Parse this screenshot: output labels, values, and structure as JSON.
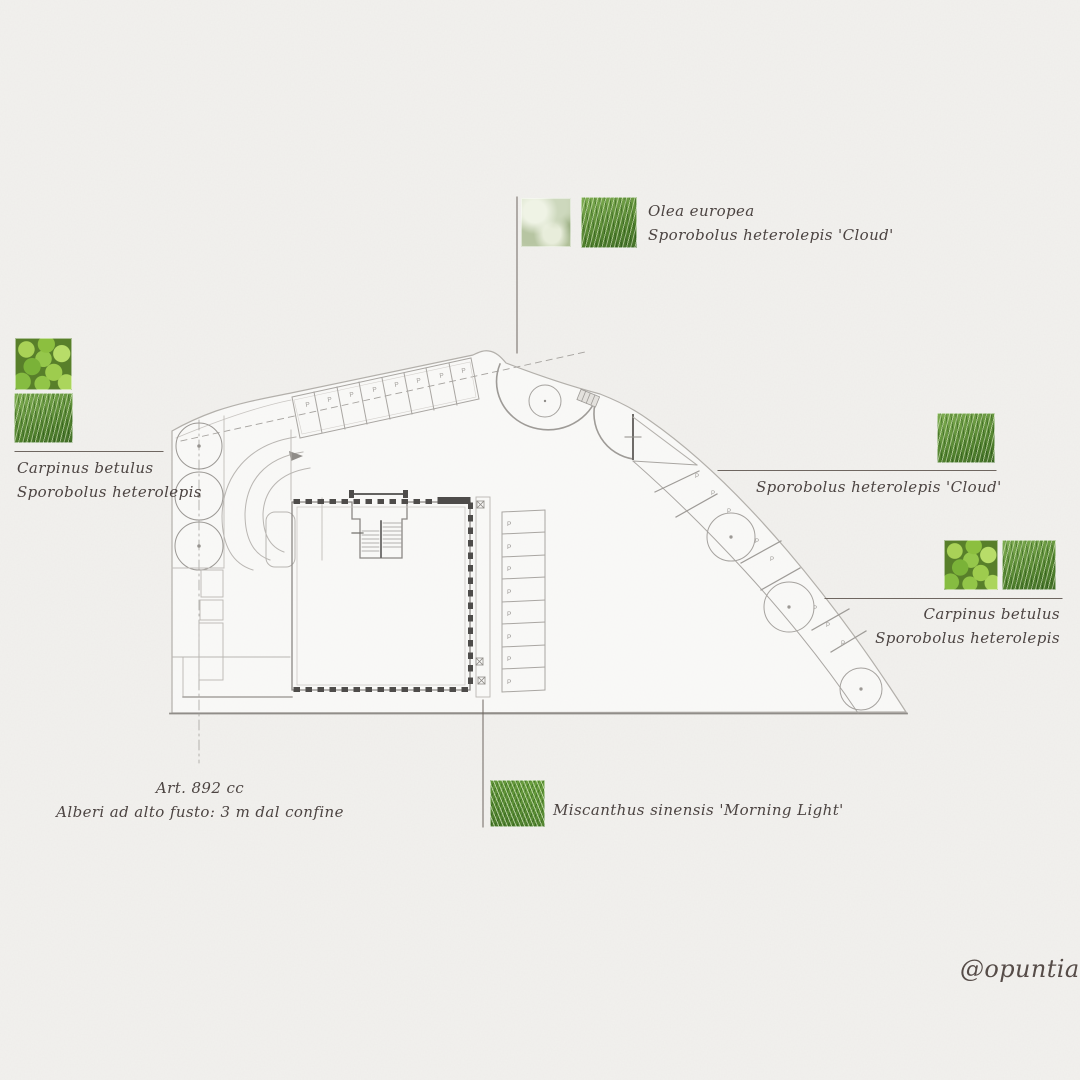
{
  "annotations": {
    "olea_group": {
      "line1": "Olea europea",
      "line2": "Sporobolus heterolepis 'Cloud'"
    },
    "left_group": {
      "line1": "Carpinus betulus",
      "line2": "Sporobolus heterolepis"
    },
    "cloud_group": {
      "line1": "Sporobolus heterolepis 'Cloud'"
    },
    "right_group": {
      "line1": "Carpinus betulus",
      "line2": "Sporobolus heterolepis"
    },
    "miscanthus_group": {
      "line1": "Miscanthus sinensis 'Morning Light'"
    },
    "law_note": {
      "line1": "Art. 892 cc",
      "line2": "Alberi ad alto fusto: 3 m dal confine"
    }
  },
  "signature": "@opuntia",
  "plan": {
    "parking_letter": "P"
  },
  "swatches": {
    "olive": "olea-foliage-photo",
    "prairie_grass": "sporobolus-grass-photo",
    "hornbeam": "carpinus-leaves-photo",
    "miscanthus": "miscanthus-grass-photo"
  },
  "colors": {
    "paper": "#f2f1ee",
    "ink": "#4c4442",
    "plan_line_light": "#b3b0ab",
    "plan_line_dark": "#4e4c4a",
    "leaf_green": "#8cbf3f",
    "grass_green": "#5e9038"
  }
}
